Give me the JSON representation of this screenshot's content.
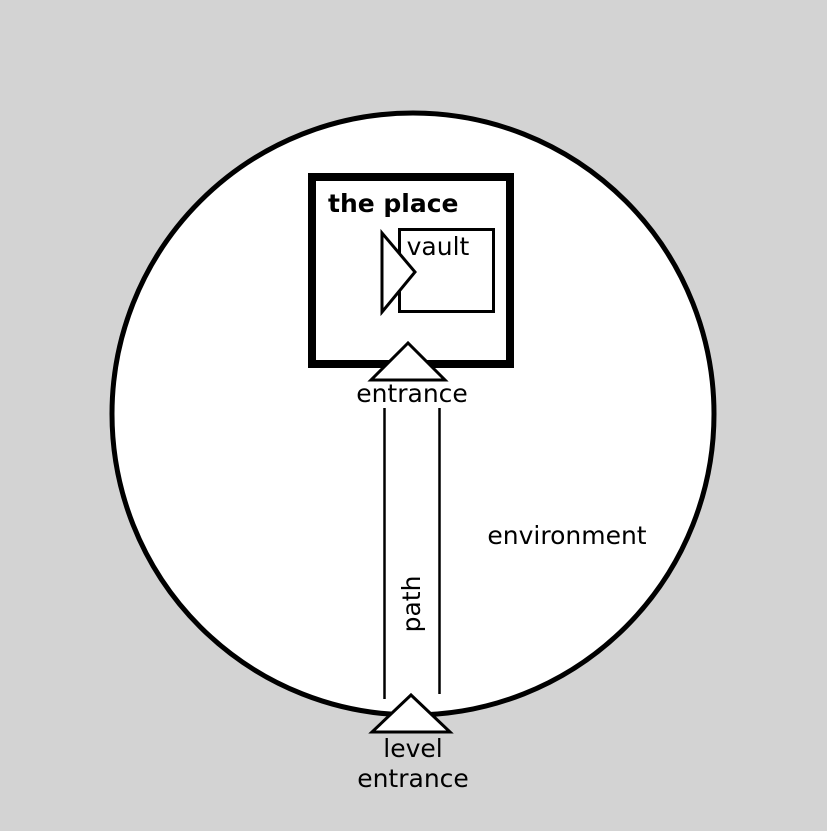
{
  "colors": {
    "bg": "#d3d3d3",
    "paper": "#ffffff",
    "ink": "#000000"
  },
  "diagram": {
    "environment_label": "environment",
    "place_label": "the place",
    "vault_label": "vault",
    "entrance_label": "entrance",
    "path_label": "path",
    "level_entrance_line1": "level",
    "level_entrance_line2": "entrance"
  }
}
